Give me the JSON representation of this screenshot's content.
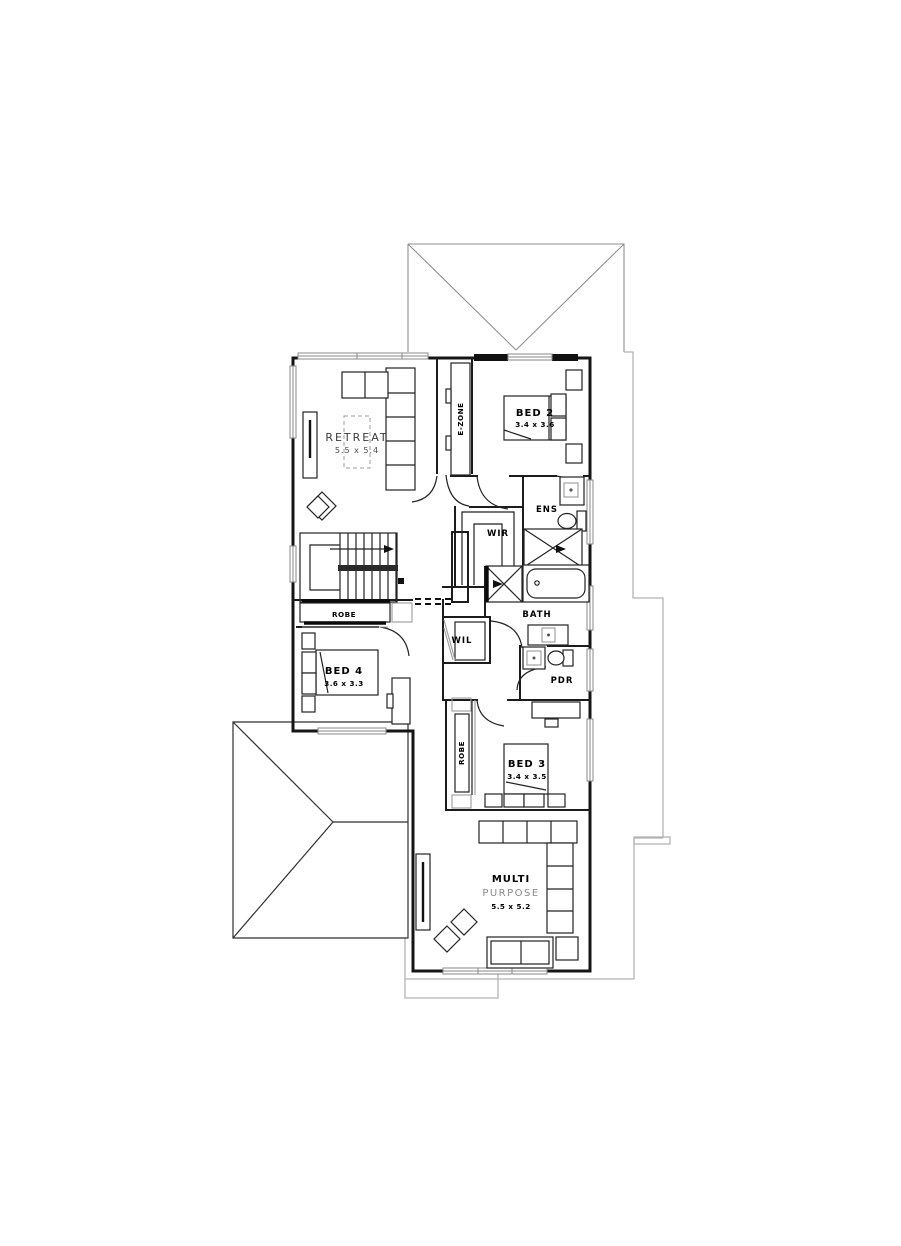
{
  "plan": {
    "rooms": {
      "retreat": {
        "name": "RETREAT",
        "dims": "5.5 x 5.4"
      },
      "bed2": {
        "name": "BED 2",
        "dims": "3.4 x 3.6"
      },
      "bed3": {
        "name": "BED 3",
        "dims": "3.4 x 3.5"
      },
      "bed4": {
        "name": "BED 4",
        "dims": "3.6 x 3.3"
      },
      "multi": {
        "name_line1": "MULTI",
        "name_line2": "PURPOSE",
        "dims": "5.5 x 5.2"
      },
      "wir": {
        "name": "WIR"
      },
      "ens": {
        "name": "ENS"
      },
      "bath": {
        "name": "BATH"
      },
      "wil": {
        "name": "WIL"
      },
      "pdr": {
        "name": "PDR"
      },
      "robe_bed4": {
        "name": "ROBE"
      },
      "robe_bed3": {
        "name": "ROBE"
      },
      "ezone": {
        "name": "E-ZONE"
      }
    },
    "colors": {
      "wall": "#151515",
      "light_outline": "#b3b3b3",
      "background": "#ffffff"
    }
  }
}
